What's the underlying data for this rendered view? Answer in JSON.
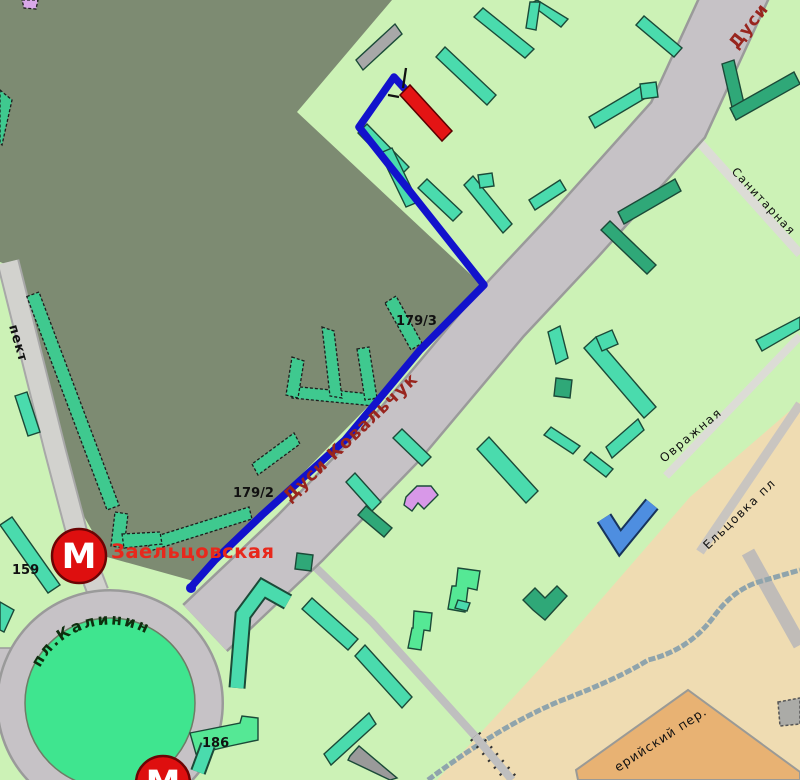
{
  "map": {
    "streets": {
      "main_street": "Дуси Ковальчук",
      "main_street_corner": "Дуси",
      "sanitarnaya": "Санитарная",
      "ovrazhnaya": "Овражная",
      "eltsovka": "Ельцовка пл",
      "prospekt_partial": "пект",
      "pereulok_partial": "ерийский пер.",
      "square": "пл.Калинина"
    },
    "stations": {
      "metro_name": "Заельцовская",
      "metro_letter": "М"
    },
    "house_numbers": {
      "h179_3": "179/3",
      "h179_2": "179/2",
      "h159": "159",
      "h186": "186"
    },
    "colors": {
      "park_olive": "#7D8B72",
      "residential_green": "#CCF2B6",
      "road_gray": "#C6C2C6",
      "road_edge": "#9A9A9A",
      "route_blue": "#1212CC",
      "tan_zone": "#EFDCB2",
      "block_orange": "#E8B273",
      "building_teal": "#4ADBAD",
      "building_dark": "#2FA878",
      "destination_red": "#E41414",
      "metro_red": "#DE0F0F",
      "station_label_red": "#E8281C",
      "street_label_red": "#98251E"
    },
    "route": {
      "description": "blue walking route from Заельцовская roundabout to highlighted red building"
    }
  }
}
